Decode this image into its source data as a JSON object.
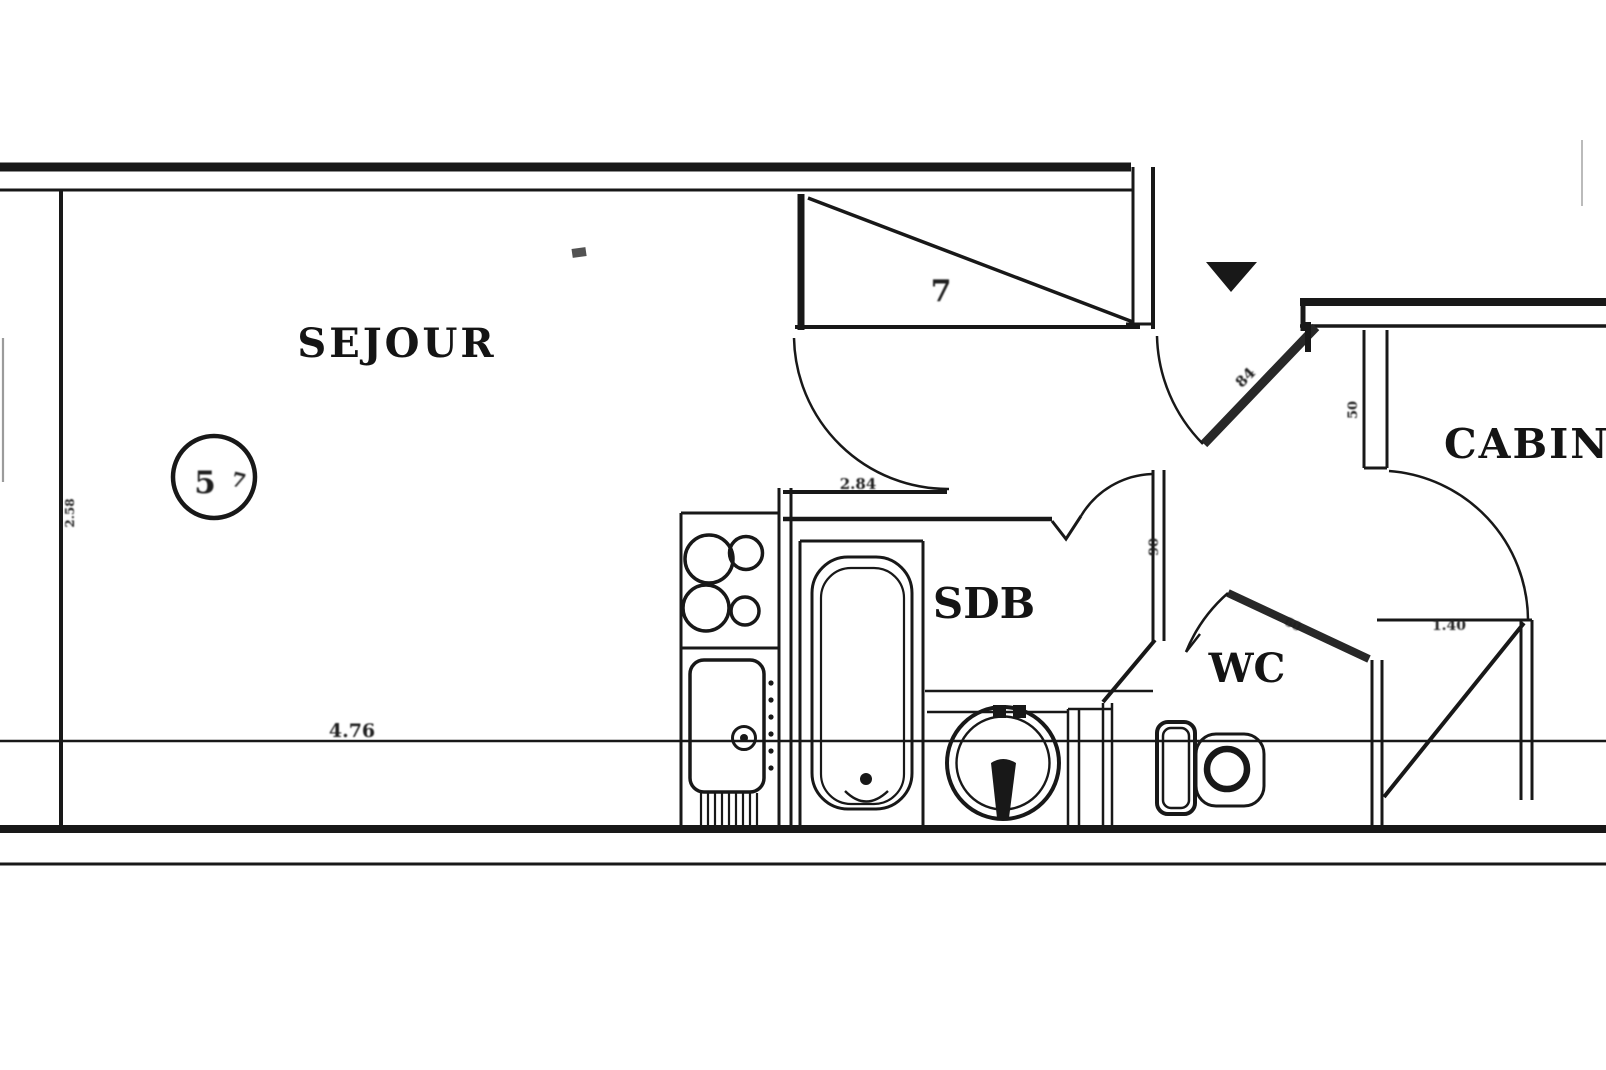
{
  "colors": {
    "ink": "#1c1c1c",
    "paper": "#ffffff"
  },
  "rooms": {
    "sejour": {
      "label": "SEJOUR"
    },
    "sdb": {
      "label": "SDB"
    },
    "wc": {
      "label": "WC"
    },
    "cabine": {
      "label": "CABINE"
    }
  },
  "annotations": {
    "dim_main": "4.76",
    "closet_mark": "7",
    "entry_door_mark": "84",
    "sdb_wall_mark": "2.84",
    "sdb_right_wall_mark": "90",
    "cabine_jamb_mark": "50",
    "cabine_closet_mark": "1.40",
    "left_wall_mark": "2.58",
    "wc_door_mark": "60",
    "circle_mark": "5",
    "circle_mark_2": "7"
  }
}
